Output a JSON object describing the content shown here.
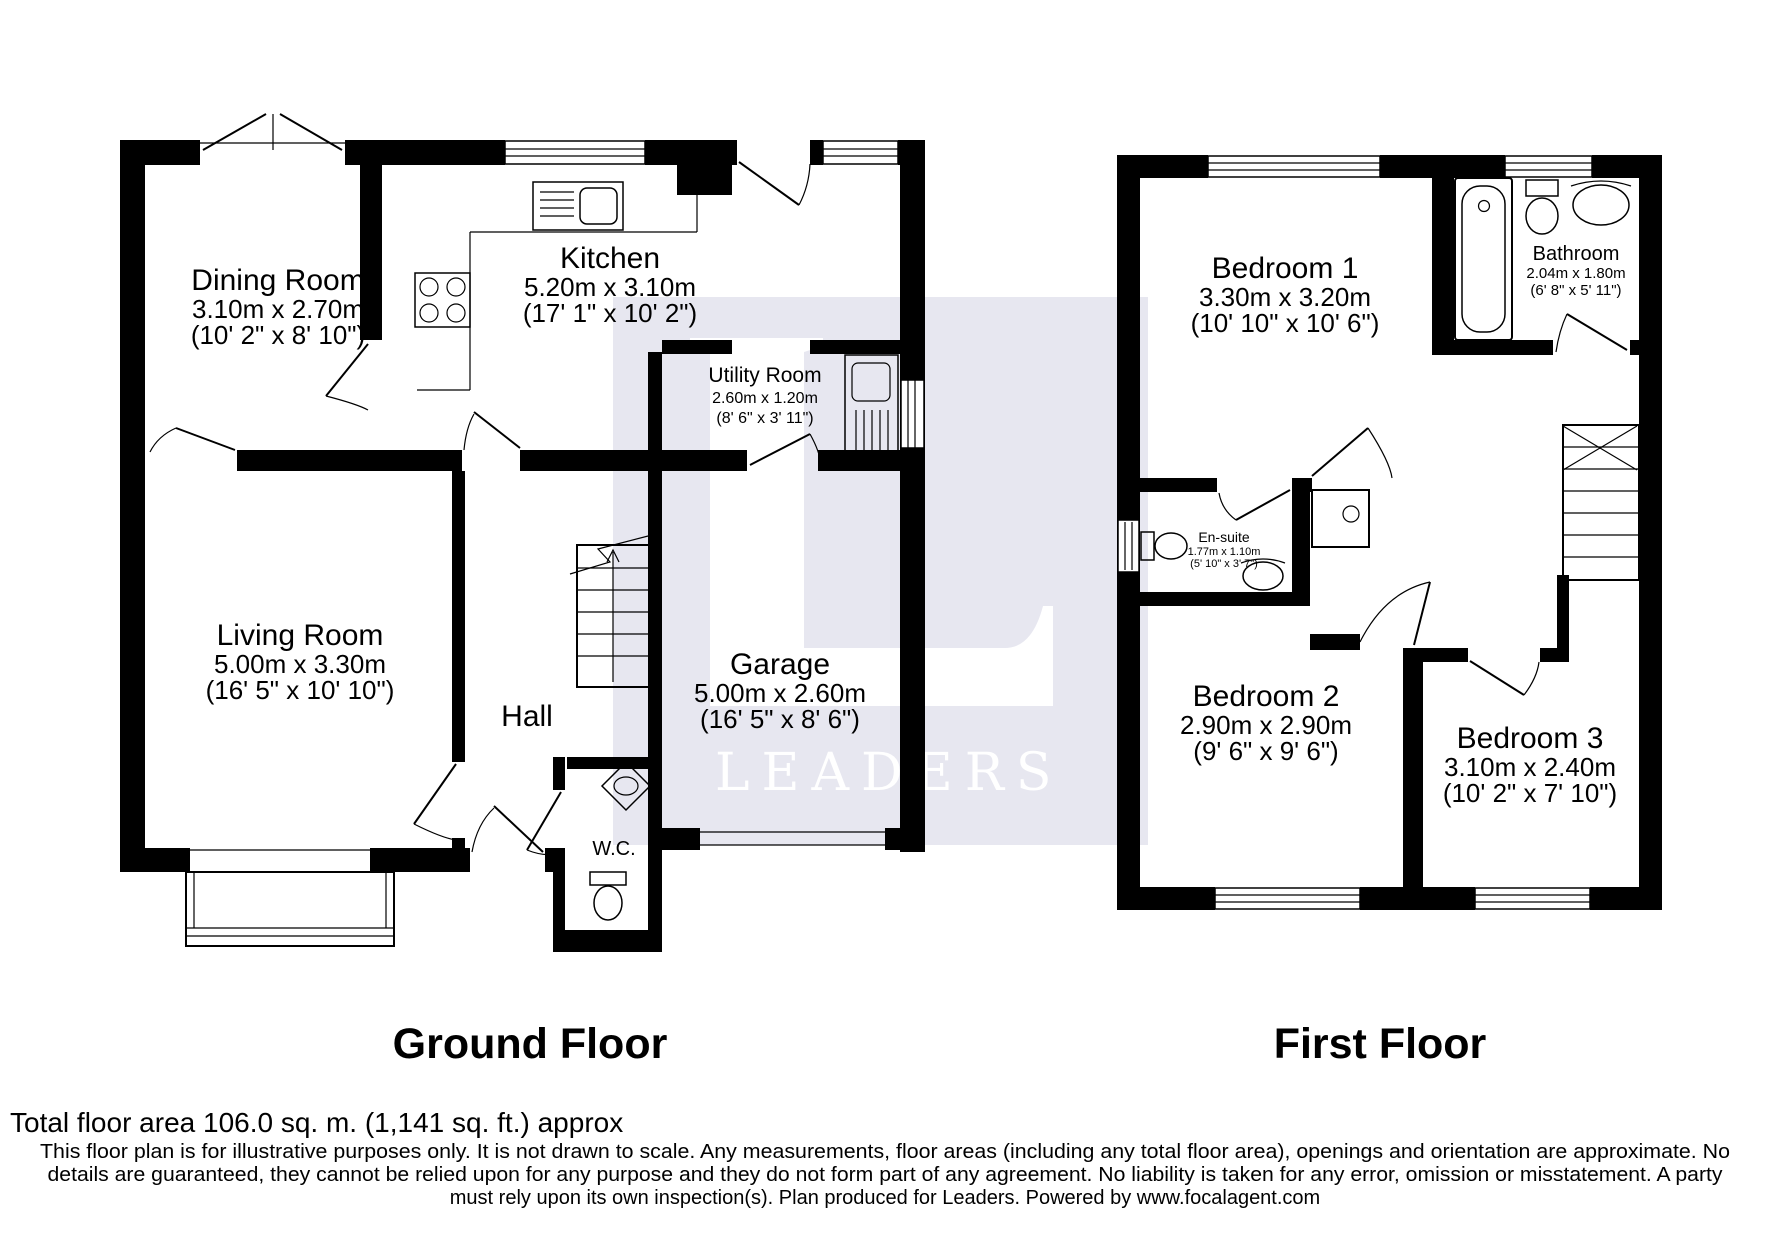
{
  "title": "Floor plan",
  "colors": {
    "walls": "#000000",
    "text": "#000000",
    "watermark_bg": "#E7E7F0",
    "watermark_fg": "#FFFFFF"
  },
  "watermark": {
    "letter": "L",
    "brand": "LEADERS"
  },
  "ground_floor": {
    "label": "Ground Floor",
    "rooms": {
      "dining": {
        "name": "Dining Room",
        "metric": "3.10m x 2.70m",
        "imperial": "(10' 2\" x 8' 10\")"
      },
      "kitchen": {
        "name": "Kitchen",
        "metric": "5.20m x 3.10m",
        "imperial": "(17' 1\" x 10' 2\")"
      },
      "utility": {
        "name": "Utility Room",
        "metric": "2.60m x 1.20m",
        "imperial": "(8' 6\" x 3' 11\")"
      },
      "living": {
        "name": "Living Room",
        "metric": "5.00m x 3.30m",
        "imperial": "(16' 5\" x 10' 10\")"
      },
      "hall": {
        "name": "Hall"
      },
      "garage": {
        "name": "Garage",
        "metric": "5.00m x 2.60m",
        "imperial": "(16' 5\" x 8' 6\")"
      },
      "wc": {
        "name": "W.C."
      }
    }
  },
  "first_floor": {
    "label": "First Floor",
    "rooms": {
      "bedroom1": {
        "name": "Bedroom 1",
        "metric": "3.30m x 3.20m",
        "imperial": "(10' 10\" x 10' 6\")"
      },
      "bathroom": {
        "name": "Bathroom",
        "metric": "2.04m x 1.80m",
        "imperial": "(6' 8\" x 5' 11\")"
      },
      "ensuite": {
        "name": "En-suite",
        "metric": "1.77m x 1.10m",
        "imperial": "(5' 10\" x 3' 7\")"
      },
      "bedroom2": {
        "name": "Bedroom 2",
        "metric": "2.90m x 2.90m",
        "imperial": "(9' 6\" x 9' 6\")"
      },
      "bedroom3": {
        "name": "Bedroom 3",
        "metric": "3.10m x 2.40m",
        "imperial": "(10' 2\" x 7' 10\")"
      }
    }
  },
  "footer": {
    "total_area": "Total floor area 106.0 sq. m. (1,141 sq. ft.) approx",
    "disclaimer": [
      "This floor plan is for illustrative purposes only. It is not drawn to scale. Any measurements, floor areas (including any total floor area), openings and orientation are approximate. No",
      "details are guaranteed, they cannot be relied upon for any purpose and they do not form part of any agreement. No liability is taken for any error, omission or misstatement. A party",
      "must rely upon its own inspection(s). Plan produced for Leaders. Powered by www.focalagent.com"
    ]
  }
}
